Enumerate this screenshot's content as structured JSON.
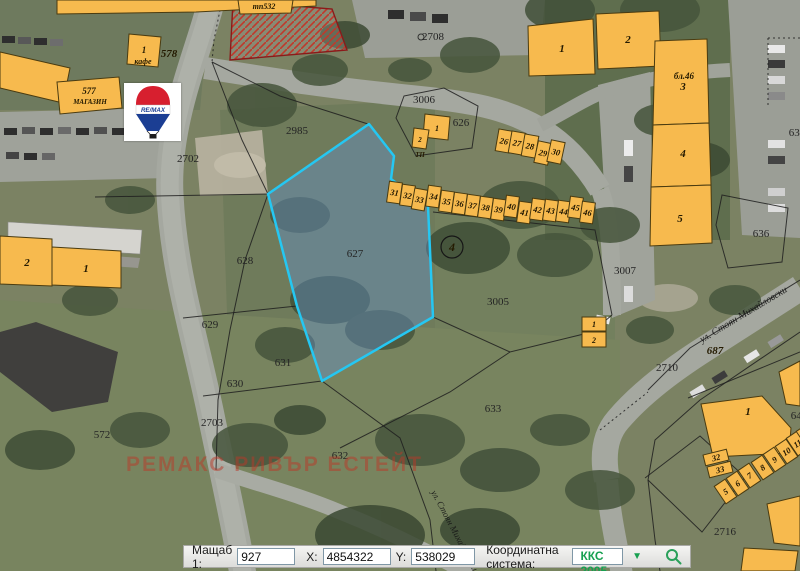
{
  "statusbar": {
    "scale_label": "Мащаб 1:",
    "scale_value": "927",
    "x_label": "X:",
    "x_value": "4854322",
    "y_label": "Y:",
    "y_value": "538029",
    "crs_label": "Координатна система:",
    "crs_value": "ККС 2005",
    "accent_color": "#17a050"
  },
  "watermark": {
    "text": "РЕМАКС РИВЪР ЕСТЕЙТ"
  },
  "logo": {
    "brand": "RE/MAX",
    "balloon_red": "#d71f2f",
    "balloon_blue": "#1b3e93"
  },
  "map": {
    "selected_parcel": {
      "id": "627",
      "pts": "369,124 394,156 391,179 428,206 433,317 322,381 297,306 268,194",
      "outline": "#25c7f2",
      "fill": "rgba(100,145,205,0.42)"
    },
    "buildings": [
      {
        "pts": "57,0 316,0 316,6 196,12 57,14"
      },
      {
        "pts": "0,52 70,68 63,103 0,88"
      },
      {
        "pts": "129,34 161,37 158,67 127,64",
        "n": "1",
        "lx": 144,
        "ly": 53,
        "fs": 9
      },
      {
        "pts": "57,82 119,77 122,108 60,114",
        "n": "577",
        "lx": 89,
        "ly": 94,
        "fs": 9
      },
      {
        "pts": "0,236 52,239 52,286 0,284",
        "n": "2",
        "lx": 27,
        "ly": 266
      },
      {
        "pts": "52,247 121,251 121,288 52,285",
        "n": "1",
        "lx": 86,
        "ly": 272
      },
      {
        "pts": "528,26 593,19 595,74 529,76",
        "n": "1",
        "lx": 562,
        "ly": 52
      },
      {
        "pts": "596,14 659,11 661,66 598,69",
        "n": "2",
        "lx": 628,
        "ly": 43
      },
      {
        "pts": "655,41 707,39 709,123 653,125",
        "n": "3",
        "lx": 683,
        "ly": 90
      },
      {
        "pts": "653,125 709,123 711,185 651,187",
        "n": "4",
        "lx": 683,
        "ly": 157
      },
      {
        "pts": "651,187 711,185 712,243 650,246",
        "n": "5",
        "lx": 680,
        "ly": 222
      },
      {
        "pts": "701,404 762,396 791,428 789,453 713,457",
        "n": "1",
        "lx": 748,
        "ly": 415
      },
      {
        "pts": "779,372 800,361 800,406 786,404"
      },
      {
        "pts": "767,504 800,496 800,546 774,543"
      },
      {
        "pts": "744,548 798,551 795,571 741,571"
      },
      {
        "pts": "238,0 293,0 291,13 240,14",
        "n": "тп532",
        "lx": 264,
        "ly": 9,
        "fs": 8
      },
      {
        "pts": "425,114 450,117 448,140 423,137",
        "n": "1",
        "lx": 437,
        "ly": 131,
        "fs": 8
      },
      {
        "pts": "414,128 429,130 426,149 412,147",
        "n": "2",
        "lx": 420,
        "ly": 142,
        "fs": 7
      },
      {
        "pts": "582,317 606,317 606,331 582,331",
        "n": "1",
        "lx": 594,
        "ly": 327,
        "fs": 8
      },
      {
        "pts": "582,332 606,332 606,347 582,347",
        "n": "2",
        "lx": 594,
        "ly": 343,
        "fs": 8
      }
    ],
    "garages": [
      {
        "n": "26",
        "x": 497,
        "y": 130,
        "w": 14,
        "h": 22,
        "r": 10
      },
      {
        "n": "27",
        "x": 510,
        "y": 132,
        "w": 14,
        "h": 22,
        "r": 10
      },
      {
        "n": "28",
        "x": 523,
        "y": 135,
        "w": 14,
        "h": 22,
        "r": 10
      },
      {
        "n": "29",
        "x": 536,
        "y": 142,
        "w": 14,
        "h": 22,
        "r": 12
      },
      {
        "n": "30",
        "x": 549,
        "y": 141,
        "w": 14,
        "h": 22,
        "r": 12
      },
      {
        "n": "31",
        "x": 388,
        "y": 182,
        "r": 8
      },
      {
        "n": "32",
        "x": 401,
        "y": 185,
        "r": 8
      },
      {
        "n": "33",
        "x": 413,
        "y": 189,
        "r": 10
      },
      {
        "n": "34",
        "x": 427,
        "y": 186,
        "r": 8
      },
      {
        "n": "35",
        "x": 440,
        "y": 191,
        "r": 8
      },
      {
        "n": "36",
        "x": 453,
        "y": 193,
        "r": 8
      },
      {
        "n": "37",
        "x": 466,
        "y": 195,
        "r": 8
      },
      {
        "n": "38",
        "x": 479,
        "y": 197,
        "r": 8
      },
      {
        "n": "39",
        "x": 492,
        "y": 199,
        "r": 8
      },
      {
        "n": "40",
        "x": 505,
        "y": 196,
        "r": 8
      },
      {
        "n": "41",
        "x": 518,
        "y": 202,
        "r": 8
      },
      {
        "n": "42",
        "x": 531,
        "y": 199,
        "r": 8
      },
      {
        "n": "43",
        "x": 544,
        "y": 200,
        "r": 8
      },
      {
        "n": "44",
        "x": 557,
        "y": 201,
        "r": 8
      },
      {
        "n": "45",
        "x": 569,
        "y": 197,
        "r": 8
      },
      {
        "n": "46",
        "x": 581,
        "y": 202,
        "r": 8
      },
      {
        "n": "32",
        "x": 704,
        "y": 452,
        "w": 24,
        "h": 11,
        "r": -14
      },
      {
        "n": "33",
        "x": 708,
        "y": 464,
        "w": 24,
        "h": 11,
        "r": -14
      },
      {
        "n": "5",
        "x": 719,
        "y": 481,
        "r": -34
      },
      {
        "n": "6",
        "x": 731,
        "y": 473,
        "r": -34
      },
      {
        "n": "7",
        "x": 743,
        "y": 465,
        "r": -34
      },
      {
        "n": "8",
        "x": 756,
        "y": 457,
        "r": -34
      },
      {
        "n": "9",
        "x": 768,
        "y": 449,
        "r": -34
      },
      {
        "n": "10",
        "x": 780,
        "y": 441,
        "r": -34
      },
      {
        "n": "11",
        "x": 791,
        "y": 433,
        "r": -34
      },
      {
        "n": "12",
        "x": 801,
        "y": 426,
        "r": -34
      }
    ],
    "labels": [
      {
        "t": "2708",
        "x": 433,
        "y": 40
      },
      {
        "t": "2985",
        "x": 297,
        "y": 134
      },
      {
        "t": "2702",
        "x": 188,
        "y": 162
      },
      {
        "t": "3006",
        "x": 424,
        "y": 103
      },
      {
        "t": "626",
        "x": 461,
        "y": 126
      },
      {
        "t": "628",
        "x": 245,
        "y": 264
      },
      {
        "t": "627",
        "x": 355,
        "y": 257
      },
      {
        "t": "629",
        "x": 210,
        "y": 328
      },
      {
        "t": "630",
        "x": 235,
        "y": 387
      },
      {
        "t": "631",
        "x": 283,
        "y": 366
      },
      {
        "t": "572",
        "x": 102,
        "y": 438
      },
      {
        "t": "2703",
        "x": 212,
        "y": 426
      },
      {
        "t": "632",
        "x": 340,
        "y": 459
      },
      {
        "t": "633",
        "x": 493,
        "y": 412
      },
      {
        "t": "3005",
        "x": 498,
        "y": 305
      },
      {
        "t": "3007",
        "x": 625,
        "y": 274
      },
      {
        "t": "2710",
        "x": 667,
        "y": 371
      },
      {
        "t": "687",
        "x": 715,
        "y": 354,
        "cls": "bnum"
      },
      {
        "t": "636",
        "x": 761,
        "y": 237
      },
      {
        "t": "637",
        "x": 797,
        "y": 136
      },
      {
        "t": "642",
        "x": 799,
        "y": 419
      },
      {
        "t": "2716",
        "x": 725,
        "y": 535
      },
      {
        "t": "578",
        "x": 169,
        "y": 57,
        "cls": "bnum"
      },
      {
        "t": "кафе",
        "x": 143,
        "y": 64,
        "cls": "bnum",
        "fs": 8
      },
      {
        "t": "МАГАЗИН",
        "x": 90,
        "y": 104,
        "cls": "bnum",
        "fs": 7
      },
      {
        "t": "бл.46",
        "x": 684,
        "y": 79,
        "cls": "bnum",
        "fs": 9
      },
      {
        "t": "ТП",
        "x": 420,
        "y": 157,
        "cls": "bnum",
        "fs": 7
      },
      {
        "t": "ул. Стоян Михайловски",
        "x": 745,
        "y": 317,
        "cls": "street",
        "rot": -31,
        "fs": 10
      },
      {
        "t": "ул. Стоян Михайловски",
        "x": 452,
        "y": 532,
        "cls": "street",
        "rot": 62,
        "fs": 9
      }
    ],
    "circles": [
      {
        "t": "4",
        "x": 452,
        "y": 247,
        "r": 11
      }
    ]
  }
}
